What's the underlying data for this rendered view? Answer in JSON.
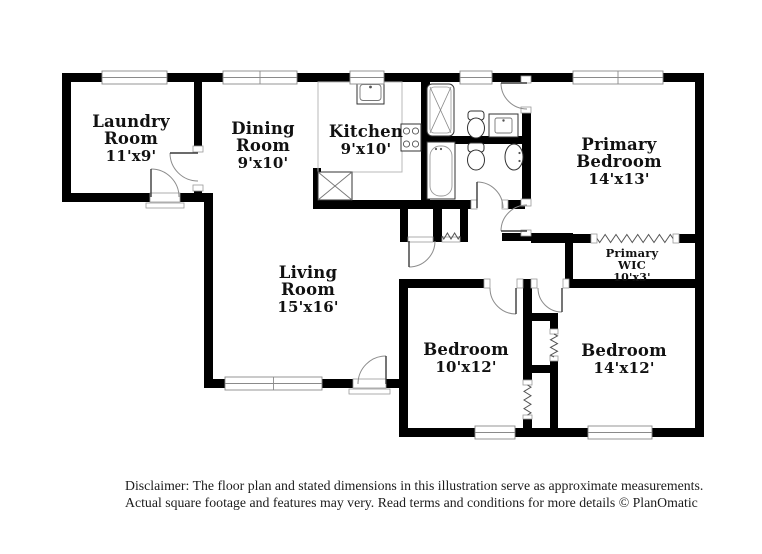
{
  "title": "Floor plan",
  "colors": {
    "wall": "#000000",
    "background": "#ffffff",
    "label_text": "#111111",
    "fixture_line": "#333333",
    "fixture_line_light": "#999999",
    "counter_line": "#b9b9b9",
    "door_arc": "#8c8c8c",
    "window_frame": "#8a8a8a",
    "disclaimer_text": "#1c1c1c"
  },
  "rooms": [
    {
      "id": "laundry-room",
      "lines": [
        "Laundry",
        "Room"
      ],
      "dim": "11'x9'",
      "x": 131,
      "y": 127,
      "lh": 17,
      "fs": 16.5,
      "dfs": 15
    },
    {
      "id": "dining-room",
      "lines": [
        "Dining",
        "Room"
      ],
      "dim": "9'x10'",
      "x": 263,
      "y": 134,
      "lh": 17,
      "fs": 16.5,
      "dfs": 15
    },
    {
      "id": "kitchen",
      "lines": [
        "Kitchen"
      ],
      "dim": "9'x10'",
      "x": 366,
      "y": 137,
      "lh": 17,
      "fs": 16.5,
      "dfs": 15
    },
    {
      "id": "primary-bedroom",
      "lines": [
        "Primary",
        "Bedroom"
      ],
      "dim": "14'x13'",
      "x": 619,
      "y": 150,
      "lh": 17,
      "fs": 16.5,
      "dfs": 15
    },
    {
      "id": "primary-wic",
      "lines": [
        "Primary",
        "WIC"
      ],
      "dim": "10'x3'",
      "x": 632,
      "y": 257,
      "lh": 12,
      "fs": 11.5,
      "dfs": 11
    },
    {
      "id": "living-room",
      "lines": [
        "Living",
        "Room"
      ],
      "dim": "15'x16'",
      "x": 308,
      "y": 278,
      "lh": 17,
      "fs": 16.5,
      "dfs": 15
    },
    {
      "id": "bedroom-10x12",
      "lines": [
        "Bedroom"
      ],
      "dim": "10'x12'",
      "x": 466,
      "y": 355,
      "lh": 17,
      "fs": 16.5,
      "dfs": 15
    },
    {
      "id": "bedroom-14x12",
      "lines": [
        "Bedroom"
      ],
      "dim": "14'x12'",
      "x": 624,
      "y": 356,
      "lh": 17,
      "fs": 16.5,
      "dfs": 15
    }
  ],
  "fixtures": [
    "kitchen-sink",
    "stove",
    "pantry-shelf",
    "shower",
    "toilet",
    "vanity-sink",
    "bathtub",
    "toilet",
    "pedestal-sink"
  ],
  "disclaimer": {
    "line1": "Disclaimer: The floor plan and stated dimensions in this illustration serve as approximate measurements.",
    "line2": "Actual square footage and features may very. Read terms and conditions for more details © PlanOmatic"
  },
  "branding": "PlanOmatic"
}
